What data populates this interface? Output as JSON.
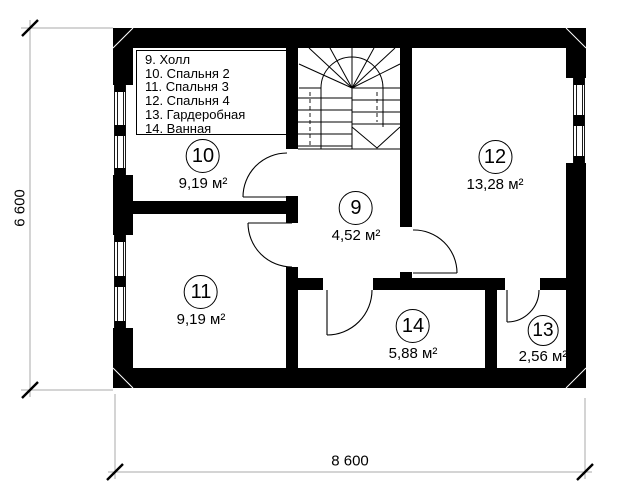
{
  "legend": {
    "items": [
      "9. Холл",
      "10. Спальня 2",
      "11. Спальня 3",
      "12. Спальня 4",
      "13. Гардеробная",
      "14. Ванная"
    ]
  },
  "rooms": [
    {
      "number": "9",
      "area": "4,52 м²"
    },
    {
      "number": "10",
      "area": "9,19 м²"
    },
    {
      "number": "11",
      "area": "9,19 м²"
    },
    {
      "number": "12",
      "area": "13,28 м²"
    },
    {
      "number": "13",
      "area": "2,56 м²"
    },
    {
      "number": "14",
      "area": "5,88 м²"
    }
  ],
  "dimensions": {
    "total_width": "8 600",
    "total_height": "6 600"
  },
  "colors": {
    "wall": "#000000",
    "dimension_line": "#a8a8a8",
    "text": "#000000",
    "background": "#ffffff"
  }
}
